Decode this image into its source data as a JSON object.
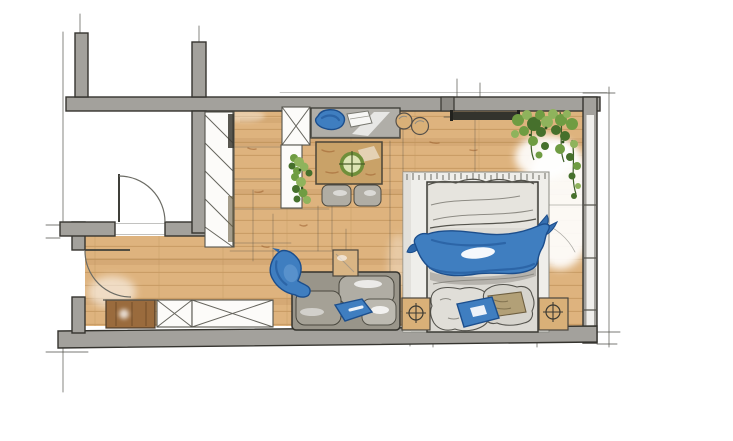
{
  "title": "Hand-drawn marker sketch floor plan of a studio apartment",
  "drawing_style": "architectural interior sketch, marker rendering, no text labels",
  "colors": {
    "paper": "#ffffff",
    "wall_gray": "#a3a19c",
    "wall_dark": "#8c8a85",
    "outline": "#35342f",
    "sketch_line": "#4c4c45",
    "floor_tan": "#deb37e",
    "floor_plank": "#c79a62",
    "floor_shadow": "#a87c48",
    "wood_table": "#c9a268",
    "wood_cabinet": "#9a6b3d",
    "nightstand_wood": "#d9b078",
    "desk_gray": "#b0aea8",
    "sofa_gray": "#99958a",
    "cushion_gray": "#b0ada4",
    "cushion_light": "#bcb9b0",
    "duvet_gray": "#dcdad4",
    "rug_white": "#efeeea",
    "blue_main": "#3f7ec0",
    "blue_dark": "#1c4e8c",
    "blue_deep": "#275d9f",
    "green_leaf": "#6f9c42",
    "green_dark": "#46702c",
    "green_light": "#8fb35c",
    "khaki": "#b2a077",
    "shelf_dark": "#33332d"
  },
  "rooms": [
    {
      "name": "main studio room",
      "floor": "wood planks (tan marker)"
    },
    {
      "name": "bathroom / side room",
      "position": "top-left",
      "floor": "white, unfurnished"
    },
    {
      "name": "entry hall",
      "position": "bottom-left",
      "floor": "wood planks"
    }
  ],
  "doors": [
    {
      "name": "side-room door",
      "location": "interior wall, top-left",
      "swing": "quarter-circle arc into side room"
    },
    {
      "name": "entry door",
      "location": "left exterior wall",
      "swing": "quarter-circle arc into entry hall"
    }
  ],
  "windows": [
    {
      "name": "window wall",
      "location": "right side, full height glazing lines"
    }
  ],
  "furniture": [
    {
      "name": "wardrobe with diagonal hatch",
      "location": "left of main room, along interior wall"
    },
    {
      "name": "tall cabinet with X symbol",
      "location": "top wall, left of desk"
    },
    {
      "name": "gray desk with blue chair and white laptop",
      "location": "against top wall"
    },
    {
      "name": "wood dining table with green round centerpiece",
      "location": "below desk"
    },
    {
      "name": "two gray dining chairs",
      "location": "below dining table"
    },
    {
      "name": "white sideboard with green plants",
      "location": "left of dining table"
    },
    {
      "name": "two round wooden stools",
      "location": "top middle-right"
    },
    {
      "name": "dark wall shelf / media board",
      "location": "top wall, right section"
    },
    {
      "name": "hanging plant",
      "location": "top-right corner"
    },
    {
      "name": "light area rug with fringe",
      "location": "under bed"
    },
    {
      "name": "double bed with gray duvet, blue throw blanket, pillows (one blue, one khaki)",
      "location": "right, headboard at bottom wall"
    },
    {
      "name": "two nightstands with round lamp symbols",
      "location": "both sides of bed"
    },
    {
      "name": "gray sofa with blue pillow",
      "location": "bottom middle, against bottom wall"
    },
    {
      "name": "blue armchair",
      "location": "left of sofa, angled"
    },
    {
      "name": "small square side table",
      "location": "behind sofa"
    },
    {
      "name": "entry closet drawn with X cross",
      "location": "entry hall, against bottom wall"
    },
    {
      "name": "brown shoe cabinet",
      "location": "entry hall, bottom-left"
    }
  ]
}
